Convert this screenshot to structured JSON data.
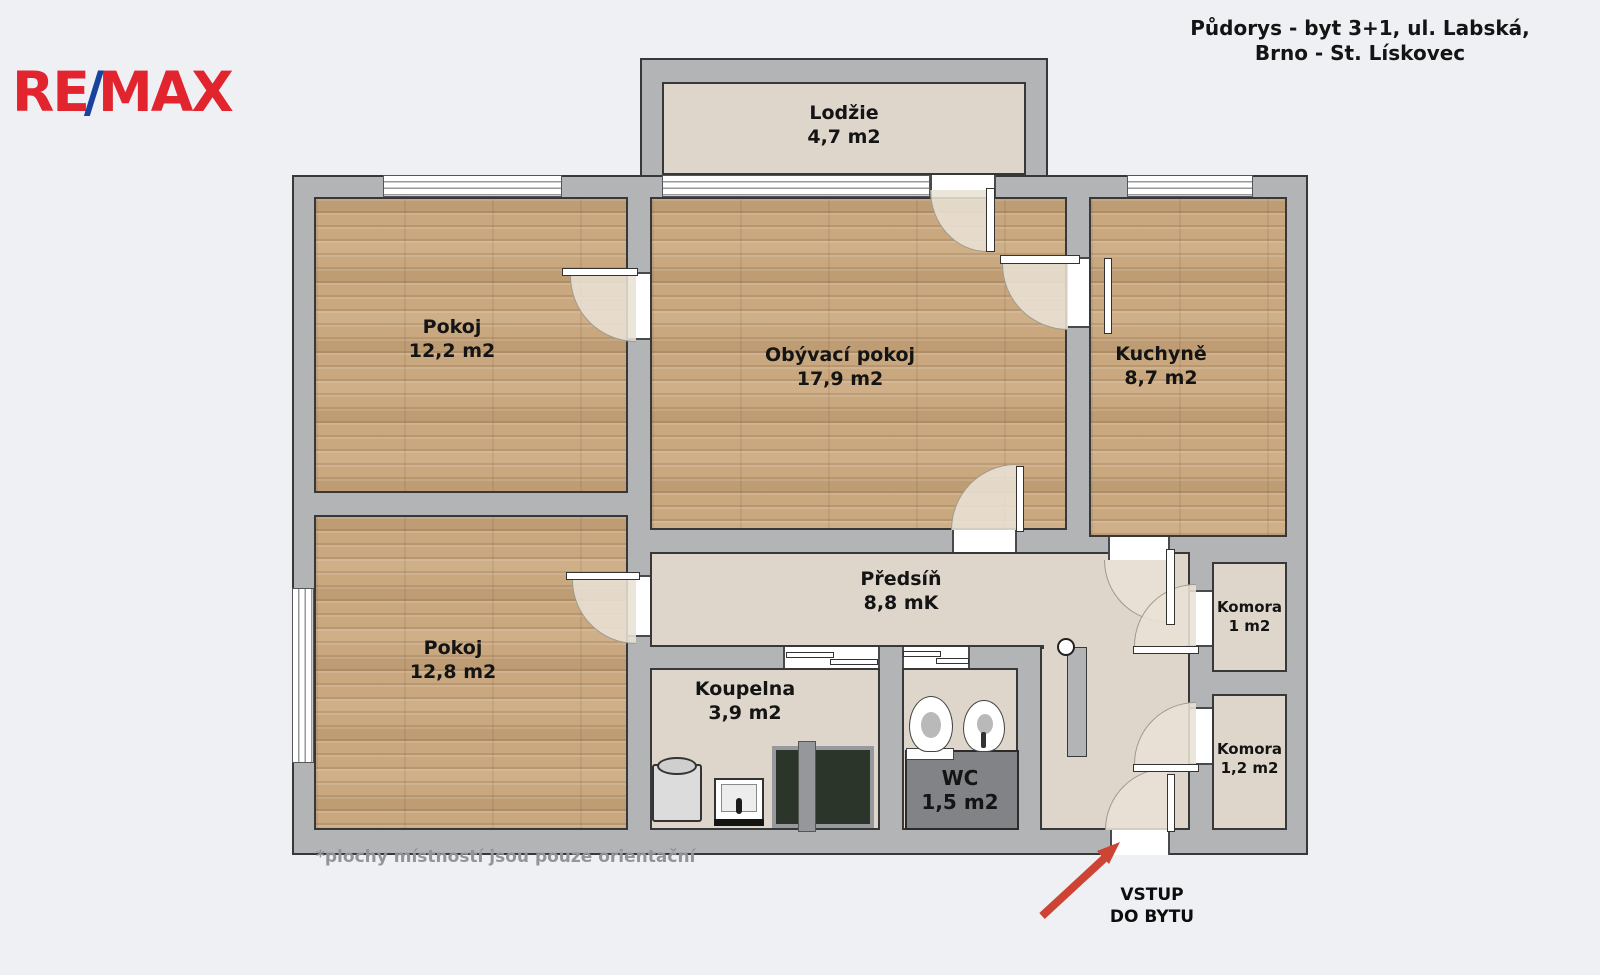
{
  "header": {
    "logo": {
      "re": "RE",
      "slash": "/",
      "max": "MAX"
    },
    "title_line1": "Půdorys - byt 3+1, ul. Labská,",
    "title_line2": "Brno - St. Lískovec"
  },
  "rooms": {
    "lodzie": {
      "name": "Lodžie",
      "area": "4,7 m2"
    },
    "pokoj1": {
      "name": "Pokoj",
      "area": "12,2 m2"
    },
    "obyvaci": {
      "name": "Obývací pokoj",
      "area": "17,9 m2"
    },
    "kuchyne": {
      "name": "Kuchyně",
      "area": "8,7 m2"
    },
    "pokoj2": {
      "name": "Pokoj",
      "area": "12,8 m2"
    },
    "predsin": {
      "name": "Předsíň",
      "area": "8,8 mK"
    },
    "koupelna": {
      "name": "Koupelna",
      "area": "3,9 m2"
    },
    "wc": {
      "name": "WC",
      "area": "1,5 m2"
    },
    "komora1": {
      "name": "Komora",
      "area": "1 m2"
    },
    "komora2": {
      "name": "Komora",
      "area": "1,2 m2"
    }
  },
  "annotations": {
    "entrance_line1": "VSTUP",
    "entrance_line2": "DO BYTU",
    "footnote": "*plochy místností jsou pouze orientační"
  },
  "colors": {
    "background": "#eef0f4",
    "wall": "#b2b4b6",
    "floor_wood": "#c9a87f",
    "floor_beige": "#ded6cb",
    "accent_red": "#cd4434",
    "logo_red": "#e1242e",
    "logo_blue": "#19429e",
    "wc_floor": "#818387"
  }
}
